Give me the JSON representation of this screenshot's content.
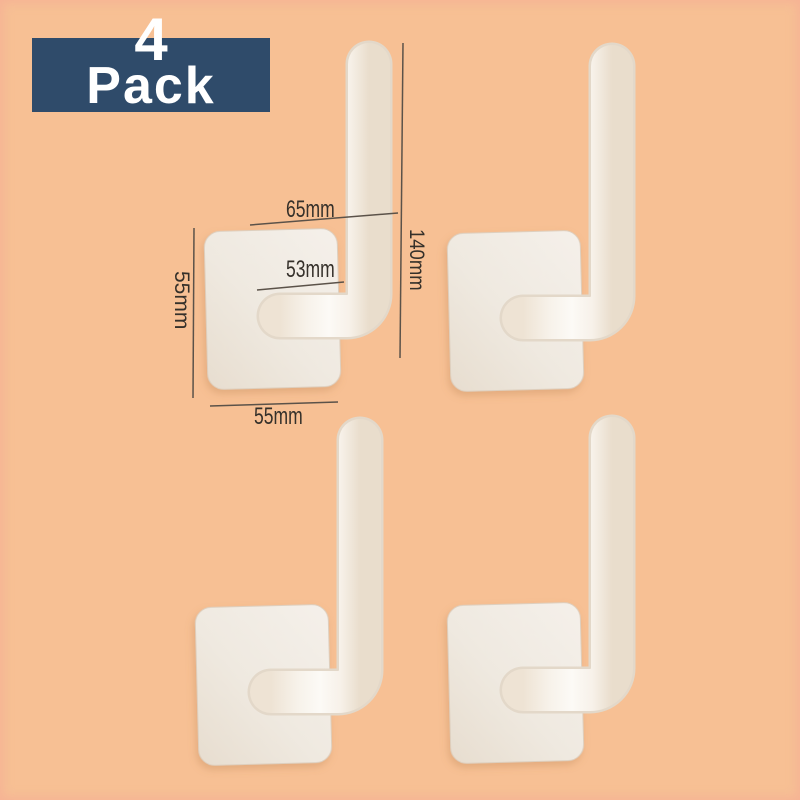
{
  "badge": {
    "count": "4",
    "label": "Pack"
  },
  "annotations": {
    "hook_top_width": "65mm",
    "hook_inner_width": "53mm",
    "plate_side_height": "55mm",
    "plate_bottom_width": "55mm",
    "hook_total_height": "140mm"
  },
  "hooks": [
    {
      "name": "hook-top-left"
    },
    {
      "name": "hook-top-right"
    },
    {
      "name": "hook-bottom-left"
    },
    {
      "name": "hook-bottom-right"
    }
  ],
  "colors": {
    "background": "#f7c094",
    "edge_tint": "#f4a896",
    "badge_bg": "#2f4b6a",
    "badge_text": "#ffffff",
    "hook_body": "#f8f4ee",
    "hook_edge": "#e3d8c9",
    "measure_line": "#5b5249",
    "measure_text": "#35302a"
  }
}
